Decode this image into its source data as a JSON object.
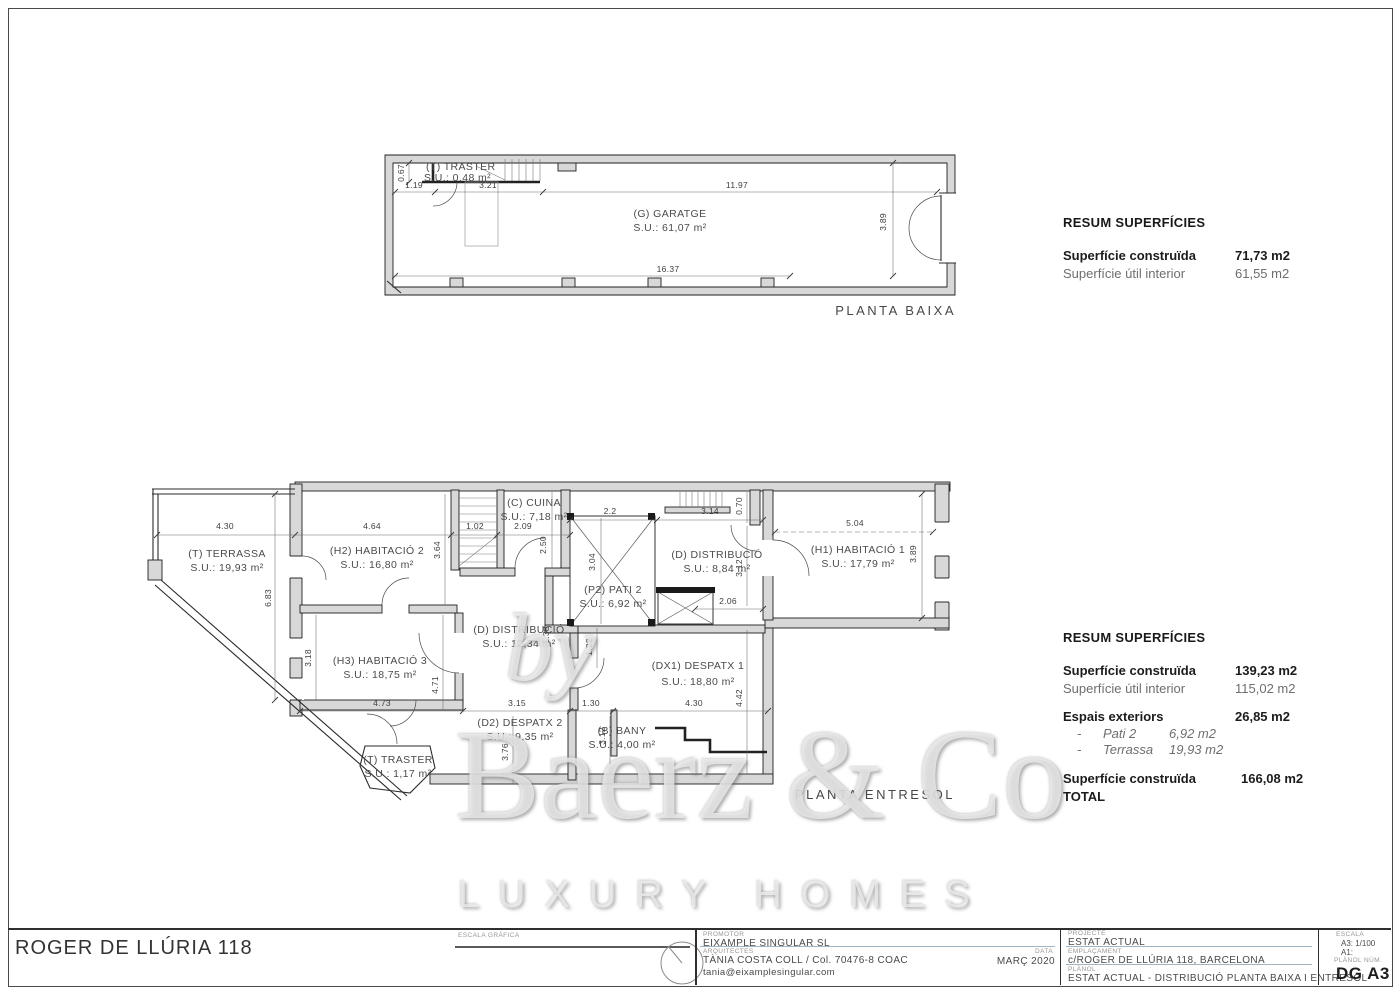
{
  "watermark": {
    "by": "by",
    "brand": "Baerz & Co",
    "tagline": "LUXURY HOMES"
  },
  "plans": {
    "pb": {
      "label": "PLANTA BAIXA",
      "rooms": {
        "traster": {
          "name": "(T) TRASTER",
          "area": "S.U.: 0,48 m²"
        },
        "garatge": {
          "name": "(G) GARATGE",
          "area": "S.U.: 61,07 m²"
        }
      },
      "dims": {
        "v067": "0.67",
        "t119": "1.19",
        "t321": "3.21",
        "t1197": "11.97",
        "b1637": "16.37",
        "v389": "3.89"
      }
    },
    "pe": {
      "label": "PLANTA ENTRESOL",
      "rooms": {
        "terrassa": {
          "name": "(T) TERRASSA",
          "area": "S.U.: 19,93 m²"
        },
        "h2": {
          "name": "(H2) HABITACIÓ 2",
          "area": "S.U.: 16,80 m²"
        },
        "h3": {
          "name": "(H3) HABITACIÓ 3",
          "area": "S.U.: 18,75 m²"
        },
        "cuina": {
          "name": "(C) CUINA",
          "area": "S.U.: 7,18 m²"
        },
        "pati2": {
          "name": "(P2) PATI 2",
          "area": "S.U.: 6,92 m²"
        },
        "dist_d": {
          "name": "(D) DISTRIBUCIÓ",
          "area": "S.U.: 8,84 m²"
        },
        "h1": {
          "name": "(H1) HABITACIÓ 1",
          "area": "S.U.: 17,79 m²"
        },
        "dist_l": {
          "name": "(D) DISTRIBUCIÓ",
          "area": "S.U.: 12,34 m²"
        },
        "dx1": {
          "name": "(DX1) DESPATX 1",
          "area": "S.U.: 18,80 m²"
        },
        "d2": {
          "name": "(D2) DESPATX 2",
          "area": "S.U.: 9,35 m²"
        },
        "bany": {
          "name": "(B) BANY",
          "area": "S.U.: 4,00 m²"
        },
        "traster2": {
          "name": "(T) TRASTER",
          "area": "S.U.: 1,17 m²"
        }
      },
      "dims": {
        "t430": "4.30",
        "t464": "4.64",
        "t102": "1.02",
        "t209": "2.09",
        "t22": "2.2",
        "t314": "3.14",
        "t504": "5.04",
        "v683": "6.83",
        "v364": "3.64",
        "v250": "2.50",
        "v304": "3.04",
        "v070": "0.70",
        "v312a": "3.12",
        "v389": "3.89",
        "v318": "3.18",
        "v471": "4.71",
        "v122": "1.22",
        "v138": "1.38",
        "v376": "3.76",
        "v312b": "3.12",
        "v442": "4.42",
        "m206": "2.06",
        "b473": "4.73",
        "b315": "3.15",
        "b130": "1.30",
        "b430": "4.30"
      }
    }
  },
  "summary_pb": {
    "title": "RESUM SUPERFÍCIES",
    "rows": [
      {
        "label": "Superfície construïda",
        "value": "71,73 m2"
      },
      {
        "label": "Superfície útil interior",
        "value": "61,55 m2"
      }
    ]
  },
  "summary_pe": {
    "title": "RESUM SUPERFÍCIES",
    "construida_label": "Superfície construïda",
    "construida_value": "139,23 m2",
    "util_label": "Superfície útil interior",
    "util_value": "115,02 m2",
    "exteriors_label": "Espais exteriors",
    "exteriors_value": "26,85 m2",
    "bullet": "-",
    "items": [
      {
        "label": "Pati 2",
        "value": "6,92 m2"
      },
      {
        "label": "Terrassa",
        "value": "19,93 m2"
      }
    ],
    "total_label": "Superfície construïda TOTAL",
    "total_value": "166,08 m2"
  },
  "titleblock": {
    "project_name": "ROGER DE LLÚRIA 118",
    "escala_grafica_label": "ESCALA GRÁFICA",
    "promotor_label": "PROMOTOR",
    "promotor_value": "EIXAMPLE SINGULAR SL",
    "arquitectes_label": "ARQUITECTES",
    "arquitectes_value": "TÀNIA COSTA COLL / Col. 70476-8 COAC",
    "arquitectes_email": "tania@eixamplesingular.com",
    "data_label": "DATA",
    "data_value": "MARÇ 2020",
    "projecte_label": "PROJECTE",
    "projecte_value": "ESTAT ACTUAL",
    "emplacament_label": "EMPLAÇAMENT",
    "emplacament_value": "c/ROGER DE LLÚRIA 118, BARCELONA",
    "planol_label": "PLÀNOL",
    "planol_value": "ESTAT ACTUAL - DISTRIBUCIÓ PLANTA BAIXA I ENTRESOL",
    "escala_label": "ESCALA",
    "escala_a3": "A3: 1/100",
    "escala_a1": "A1:",
    "planol_num_label": "PLÀNOL NÚM.",
    "planol_num_value": "DG A3"
  }
}
